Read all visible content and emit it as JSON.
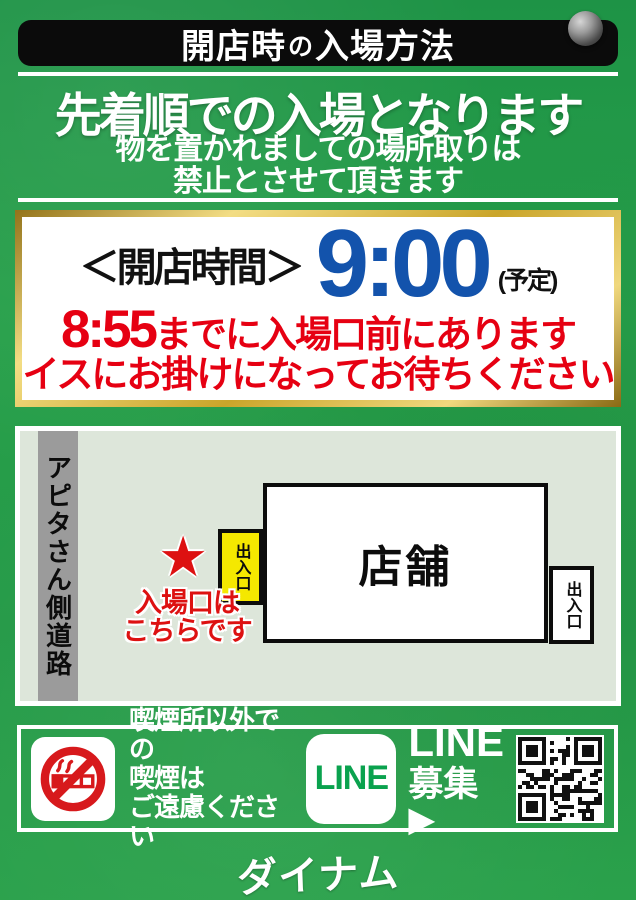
{
  "colors": {
    "background_green": "#259a48",
    "banner_black": "#0b0b0b",
    "time_blue": "#1353ac",
    "warning_red": "#e60012",
    "entrance_yellow": "#f5e800",
    "line_green": "#0aa24e",
    "map_background": "#dde6da",
    "road_gray": "#9b9b9b",
    "gold_border": "#caa52a",
    "no_smoking_red": "#d7191c"
  },
  "banner": {
    "pre": "開店時",
    "particle": "の",
    "post": "入場方法"
  },
  "headline": "先着順での入場となります",
  "notice": {
    "line1": "物を置かれましての場所取りは",
    "line2": "禁止とさせて頂きます"
  },
  "hours_card": {
    "label": "＜開店時間＞",
    "time": "9:00",
    "note": "(予定)",
    "warning_time": "8:55",
    "warning_rest": "までに入場口前にあります",
    "warning_line2": "イスにお掛けになってお待ちください"
  },
  "map": {
    "road_label": "アピタさん側道路",
    "building_label": "店舗",
    "entrance_left": "出入口",
    "entrance_right": "出入口",
    "star": "★",
    "note_line1": "入場口は",
    "note_line2": "こちらです"
  },
  "footer": {
    "smoking_line1": "喫煙所以外での",
    "smoking_line2": "喫煙は",
    "smoking_line3": "ご遠慮ください",
    "line_logo": "LINE",
    "line_label_line1": "LINE",
    "line_label_line2": "募集▶"
  },
  "brand": "ダイナム"
}
